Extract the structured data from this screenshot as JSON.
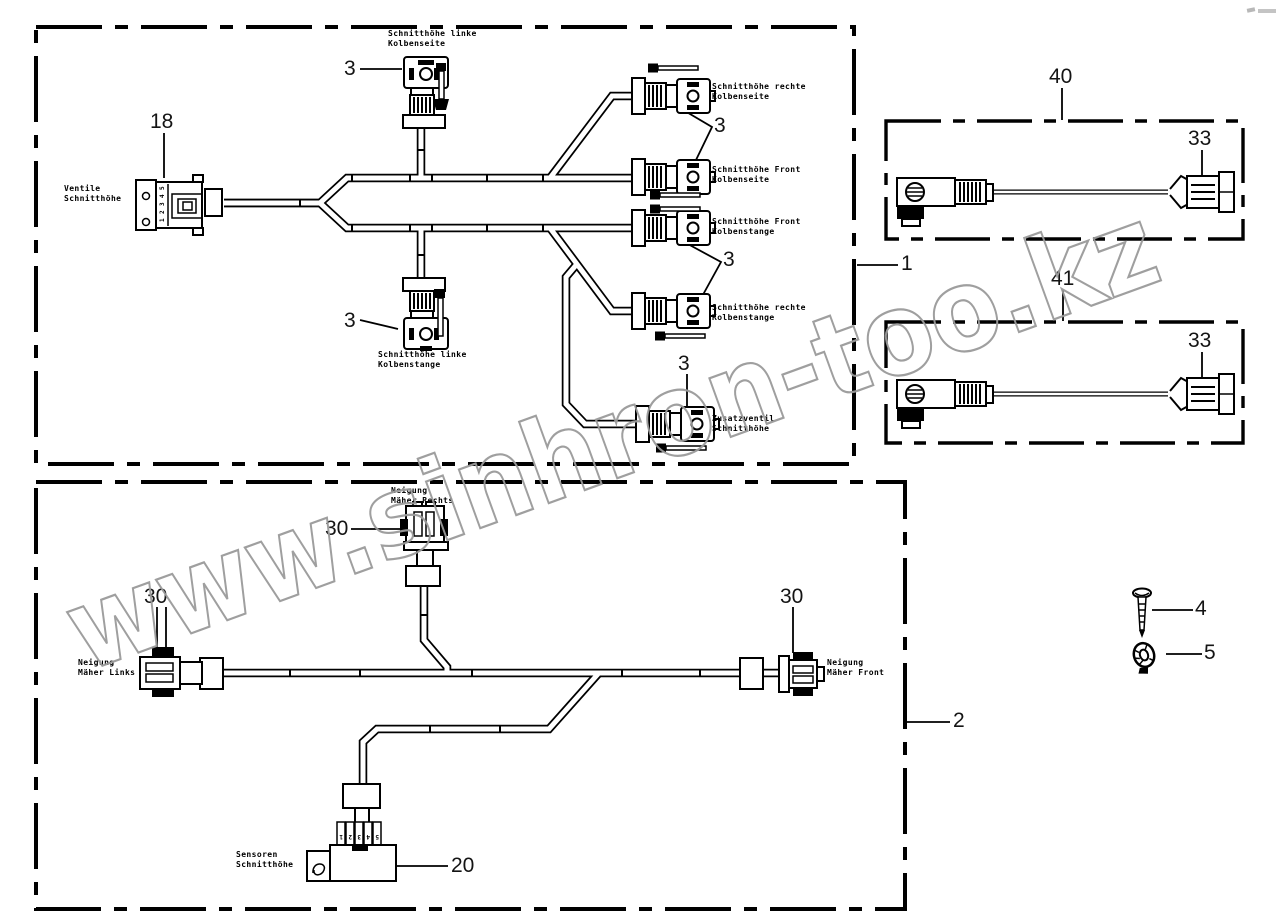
{
  "watermark": {
    "text": "www.sinhron-too.kz"
  },
  "part_numbers": {
    "n1": "1",
    "n2": "2",
    "n3": "3",
    "n4": "4",
    "n5": "5",
    "n18": "18",
    "n20": "20",
    "n30": "30",
    "n33": "33",
    "n40": "40",
    "n41": "41"
  },
  "component_labels": {
    "ventile_schnitthoehe": {
      "line1": "Ventile",
      "line2": "Schnitthöhe"
    },
    "schnitthoehe_linke_kolbenseite": {
      "line1": "Schnitthöhe linke",
      "line2": "Kolbenseite"
    },
    "schnitthoehe_rechte_kolbenseite": {
      "line1": "Schnitthöhe rechte",
      "line2": "Kolbenseite"
    },
    "schnitthoehe_front_kolbenseite": {
      "line1": "Schnitthöhe Front",
      "line2": "Kolbenseite"
    },
    "schnitthoehe_front_kolbenstange": {
      "line1": "Schnitthöhe Front",
      "line2": "Kolbenstange"
    },
    "schnitthoehe_rechte_kolbenstange": {
      "line1": "Schnitthöhe rechte",
      "line2": "Kolbenstange"
    },
    "zusatzventil_schnitthoehe": {
      "line1": "Zusatzventil",
      "line2": "Schnitthöhe"
    },
    "schnitthoehe_linke_kolbenstange": {
      "line1": "Schnitthöhe linke",
      "line2": "Kolbenstange"
    },
    "neigung_maeher_rechts": {
      "line1": "Neigung",
      "line2": "Mäher Rechts"
    },
    "neigung_maeher_links": {
      "line1": "Neigung",
      "line2": "Mäher Links"
    },
    "neigung_maeher_front": {
      "line1": "Neigung",
      "line2": "Mäher Front"
    },
    "sensoren_schnitthoehe": {
      "line1": "Sensoren",
      "line2": "Schnitthöhe"
    }
  },
  "connector_pins": {
    "plug18": [
      "5",
      "4",
      "3",
      "2",
      "1"
    ],
    "sensor20": [
      "5",
      "4",
      "3",
      "2",
      "1"
    ]
  }
}
